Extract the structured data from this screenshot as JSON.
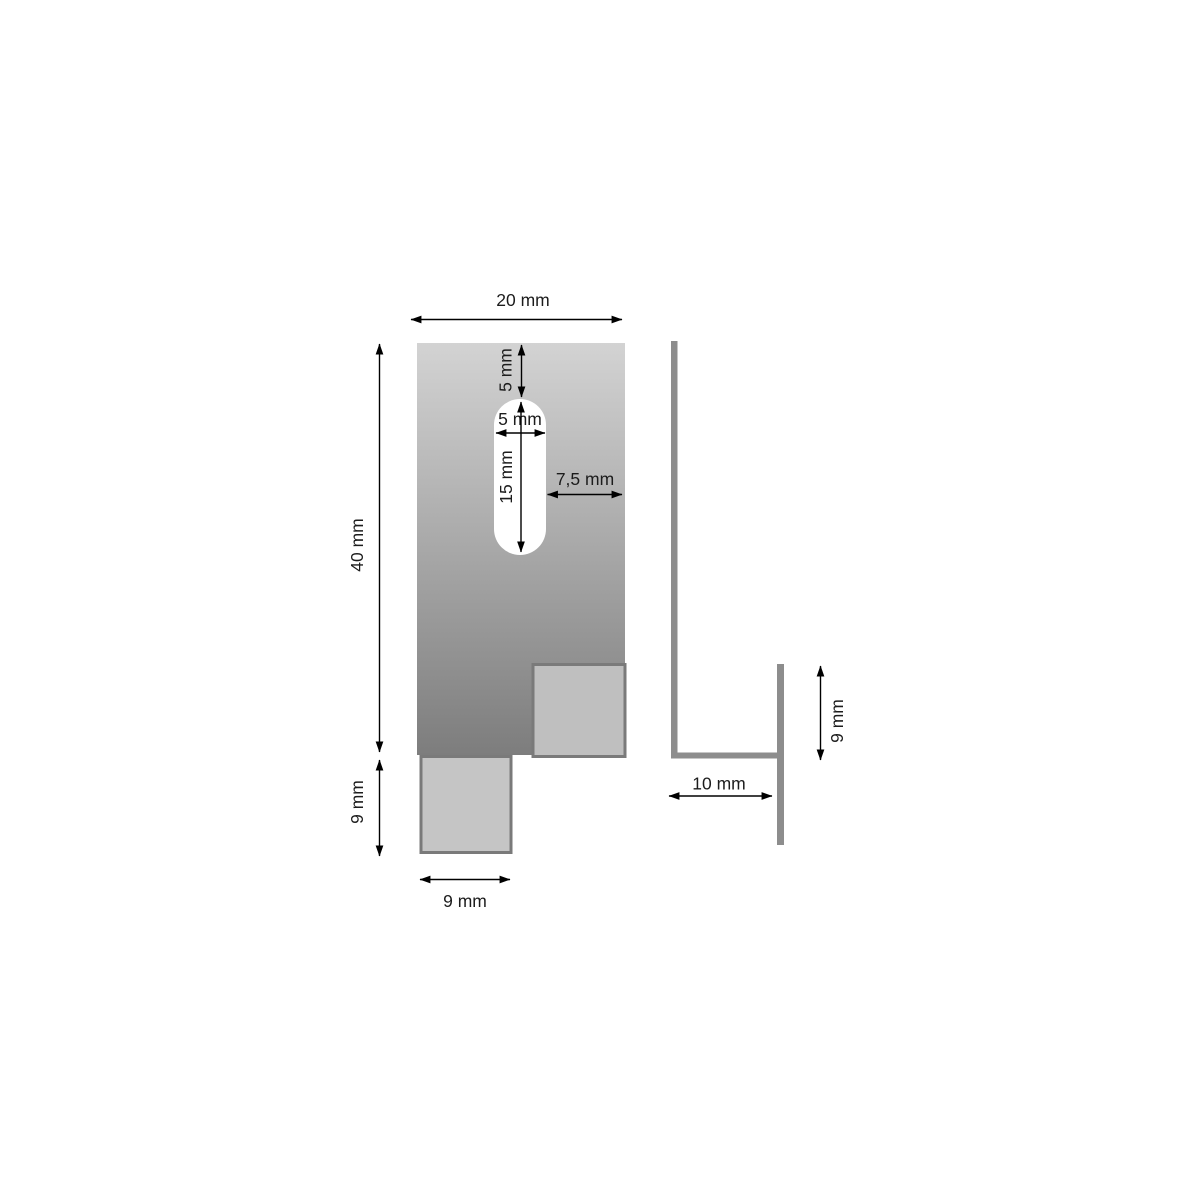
{
  "drawing": {
    "views": {
      "front": "front-view-plate-with-slot-and-tabs",
      "side": "side-profile-view"
    },
    "dimensions": {
      "plate_width": "20 mm",
      "plate_height": "40 mm",
      "slot_top_offset": "5 mm",
      "slot_width": "5 mm",
      "slot_length": "15 mm",
      "slot_to_edge": "7,5 mm",
      "tab_height": "9 mm",
      "tab_width": "9 mm",
      "side_leg_length": "10 mm",
      "side_flange_height": "9 mm"
    },
    "colors": {
      "background": "#ffffff",
      "plate_gradient_top": "#d3d3d3",
      "plate_gradient_bottom": "#7d7d7d",
      "slot_fill": "#ffffff",
      "tab_left_fill": "#c5c5c5",
      "tab_right_fill": "#bfbfbf",
      "tab_border": "#7a7a7a",
      "profile_bar": "#8d8d8d",
      "dimension_line": "#000000",
      "label_text": "#1c1c1c"
    }
  }
}
